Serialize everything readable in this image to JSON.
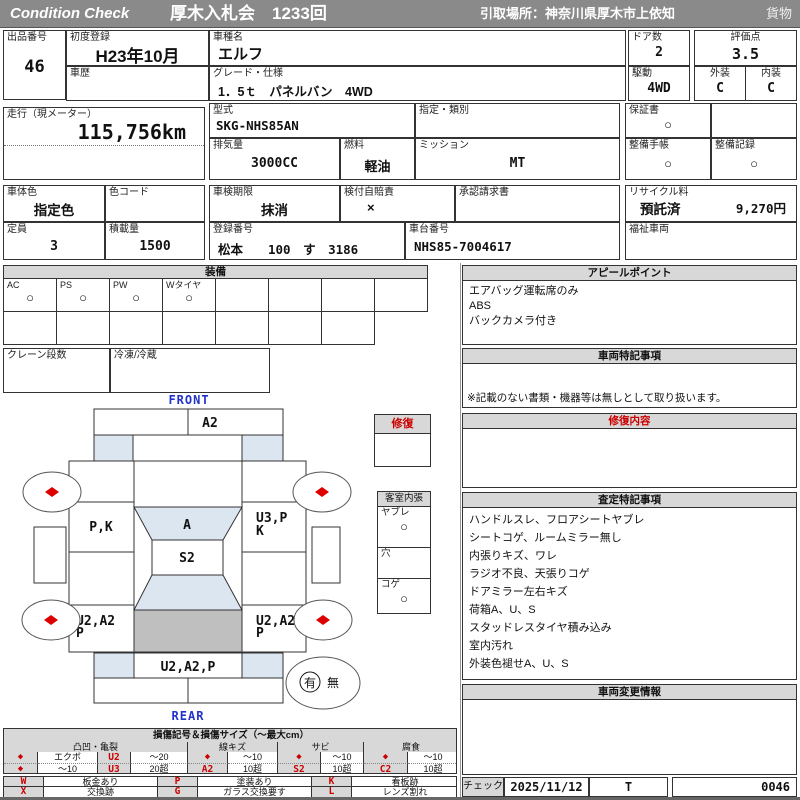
{
  "header": {
    "brand": "Condition  Check",
    "auction": "厚木入札会　1233回",
    "pickup": "引取場所：神奈川県厚木市上依知",
    "category": "貨物"
  },
  "fields": {
    "lot": {
      "label": "出品番号",
      "value": "46"
    },
    "first_reg": {
      "label": "初度登録",
      "value": "H23年10月"
    },
    "model": {
      "label": "車種名",
      "value": "エルフ"
    },
    "history": {
      "label": "車歴",
      "value": ""
    },
    "grade": {
      "label": "グレード・仕様",
      "value": "1．5ｔ　パネルバン　4WD"
    },
    "doors": {
      "label": "ドア数",
      "value": "2"
    },
    "drive": {
      "label": "駆動",
      "value": "4WD"
    },
    "score": {
      "label": "評価点",
      "value": "3.5"
    },
    "exterior": {
      "label": "外装",
      "value": "C"
    },
    "interior": {
      "label": "内装",
      "value": "C"
    },
    "mileage": {
      "label": "走行（現メーター）",
      "value": "115,756km"
    },
    "model_code": {
      "label": "型式",
      "value": "SKG-NHS85AN"
    },
    "classification": {
      "label": "指定・類別",
      "value": ""
    },
    "displacement": {
      "label": "排気量",
      "value": "3000CC"
    },
    "fuel": {
      "label": "燃料",
      "value": "軽油"
    },
    "transmission": {
      "label": "ミッション",
      "value": "MT"
    },
    "warranty": {
      "label": "保証書",
      "value": "○"
    },
    "maintenance_book": {
      "label": "整備手帳",
      "value": "○"
    },
    "maintenance_record": {
      "label": "整備記録",
      "value": "○"
    },
    "body_color": {
      "label": "車体色",
      "value": "指定色"
    },
    "color_code": {
      "label": "色コード",
      "value": ""
    },
    "capacity": {
      "label": "定員",
      "value": "3"
    },
    "load": {
      "label": "積載量",
      "value": "1500"
    },
    "inspection": {
      "label": "車検期限",
      "value": "抹消"
    },
    "insurance": {
      "label": "検付自賠責",
      "value": "×"
    },
    "approval": {
      "label": "承認請求書",
      "value": ""
    },
    "reg_no": {
      "label": "登録番号",
      "value": "松本　　100　す　3186"
    },
    "chassis_no": {
      "label": "車台番号",
      "value": "NHS85-7004617"
    },
    "recycle": {
      "label": "リサイクル料",
      "status": "預託済",
      "fee": "9,270円"
    },
    "welfare": {
      "label": "福祉車両",
      "value": ""
    }
  },
  "equipment": {
    "title": "装備",
    "row1": [
      {
        "label": "AC",
        "mark": "○"
      },
      {
        "label": "PS",
        "mark": "○"
      },
      {
        "label": "PW",
        "mark": "○"
      },
      {
        "label": "Wタイヤ",
        "mark": "○"
      },
      {
        "label": "",
        "mark": ""
      },
      {
        "label": "",
        "mark": ""
      },
      {
        "label": "",
        "mark": ""
      },
      {
        "label": "",
        "mark": ""
      }
    ],
    "crane": {
      "label": "クレーン段数",
      "value": ""
    },
    "reefer": {
      "label": "冷凍/冷蔵",
      "value": ""
    }
  },
  "panels": {
    "appeal": {
      "title": "アピールポイント",
      "lines": [
        "エアバッグ運転席のみ",
        "ABS",
        "バックカメラ付き"
      ]
    },
    "vehicle_notes": {
      "title": "車両特記事項",
      "note": "※記載のない書類・機器等は無しとして取り扱います。"
    },
    "repair": {
      "title": "修復内容"
    },
    "assessment": {
      "title": "査定特記事項",
      "lines": [
        "ハンドルスレ、フロアシートヤブレ",
        "シートコゲ、ルームミラー無し",
        "内張りキズ、ワレ",
        "ラジオ不良、天張りコゲ",
        "ドアミラー左右キズ",
        "荷箱A、U、S",
        "スタッドレスタイヤ積み込み",
        "室内汚れ",
        "外装色褪せA、U、S"
      ]
    },
    "changes": {
      "title": "車両変更情報"
    }
  },
  "diagram": {
    "front": "FRONT",
    "rear": "REAR",
    "marks": {
      "front_panel": "A2",
      "left_door": "P,K",
      "cab_front": "A",
      "roof": "S2",
      "right_door_1": "U3,P",
      "right_door_2": "K",
      "left_rear_1": "U2,A2",
      "left_rear_2": "P",
      "right_rear_1": "U2,A2",
      "right_rear_2": "P",
      "rear_panel": "U2,A2,P"
    },
    "repair_box": {
      "title": "修復"
    },
    "interior_box": {
      "title": "客室内張",
      "rows": [
        {
          "label": "ヤブレ",
          "mark": "○"
        },
        {
          "label": "穴",
          "mark": ""
        },
        {
          "label": "コゲ",
          "mark": "○"
        }
      ]
    },
    "presence": {
      "yes": "有",
      "no": "無"
    }
  },
  "legend": {
    "title": "損傷記号＆損傷サイズ（～最大cm）",
    "groups": [
      {
        "name": "凸凹・亀裂",
        "r1": [
          "◆",
          "エクボ",
          "U2",
          "～20"
        ],
        "r2": [
          "◆",
          "～10",
          "U3",
          "20超"
        ]
      },
      {
        "name": "線キズ",
        "r1": [
          "◆",
          "～10"
        ],
        "r2": [
          "A2",
          "10超"
        ]
      },
      {
        "name": "サビ",
        "r1": [
          "◆",
          "～10"
        ],
        "r2": [
          "S2",
          "10超"
        ]
      },
      {
        "name": "腐食",
        "r1": [
          "◆",
          "～10"
        ],
        "r2": [
          "C2",
          "10超"
        ]
      }
    ],
    "codes": {
      "r1": [
        "W",
        "板金あり",
        "P",
        "塗装あり",
        "K",
        "看板跡"
      ],
      "r2": [
        "X",
        "交換跡",
        "G",
        "ガラス交換要す",
        "L",
        "レンズ割れ"
      ]
    }
  },
  "footer": {
    "check_label": "チェック",
    "date": "2025/11/12",
    "inspector": "T",
    "number": "0046"
  },
  "colors": {
    "accent_red": "#cc0000",
    "header_gray": "#8a8a8a",
    "panel_gray": "#d8d8d8",
    "diagram_blue": "#dce6f1",
    "cargo_gray": "#bfbfbf",
    "label_blue": "#2233cc"
  }
}
